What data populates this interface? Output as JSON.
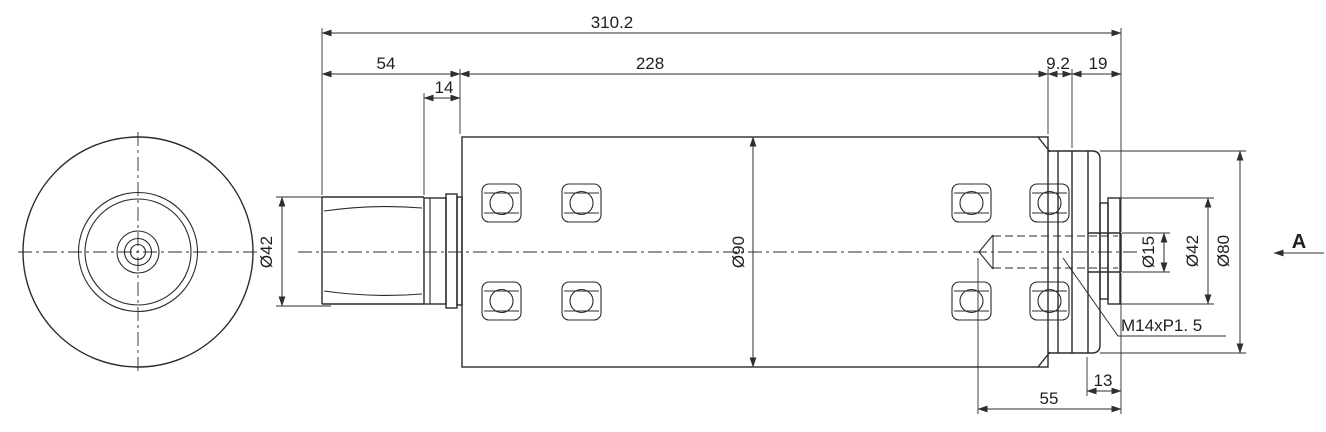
{
  "drawing": {
    "kind": "engineering-drawing-spindle",
    "background": "#ffffff",
    "line_color": "#2b2b2b",
    "view_label": "A",
    "dims": {
      "overall_length": "310.2",
      "shaft_length": "54",
      "body_length": "228",
      "collar_width": "14",
      "rear_ring_width": "9.2",
      "rear_end_length": "19",
      "shaft_diameter": "Ø42",
      "body_diameter": "Ø90",
      "tip_diameter": "Ø15",
      "rear_disc_diameter": "Ø42",
      "rear_cap_diameter": "Ø80",
      "thread_callout": "M14xP1. 5",
      "tip_length": "13",
      "thread_depth": "55"
    }
  }
}
